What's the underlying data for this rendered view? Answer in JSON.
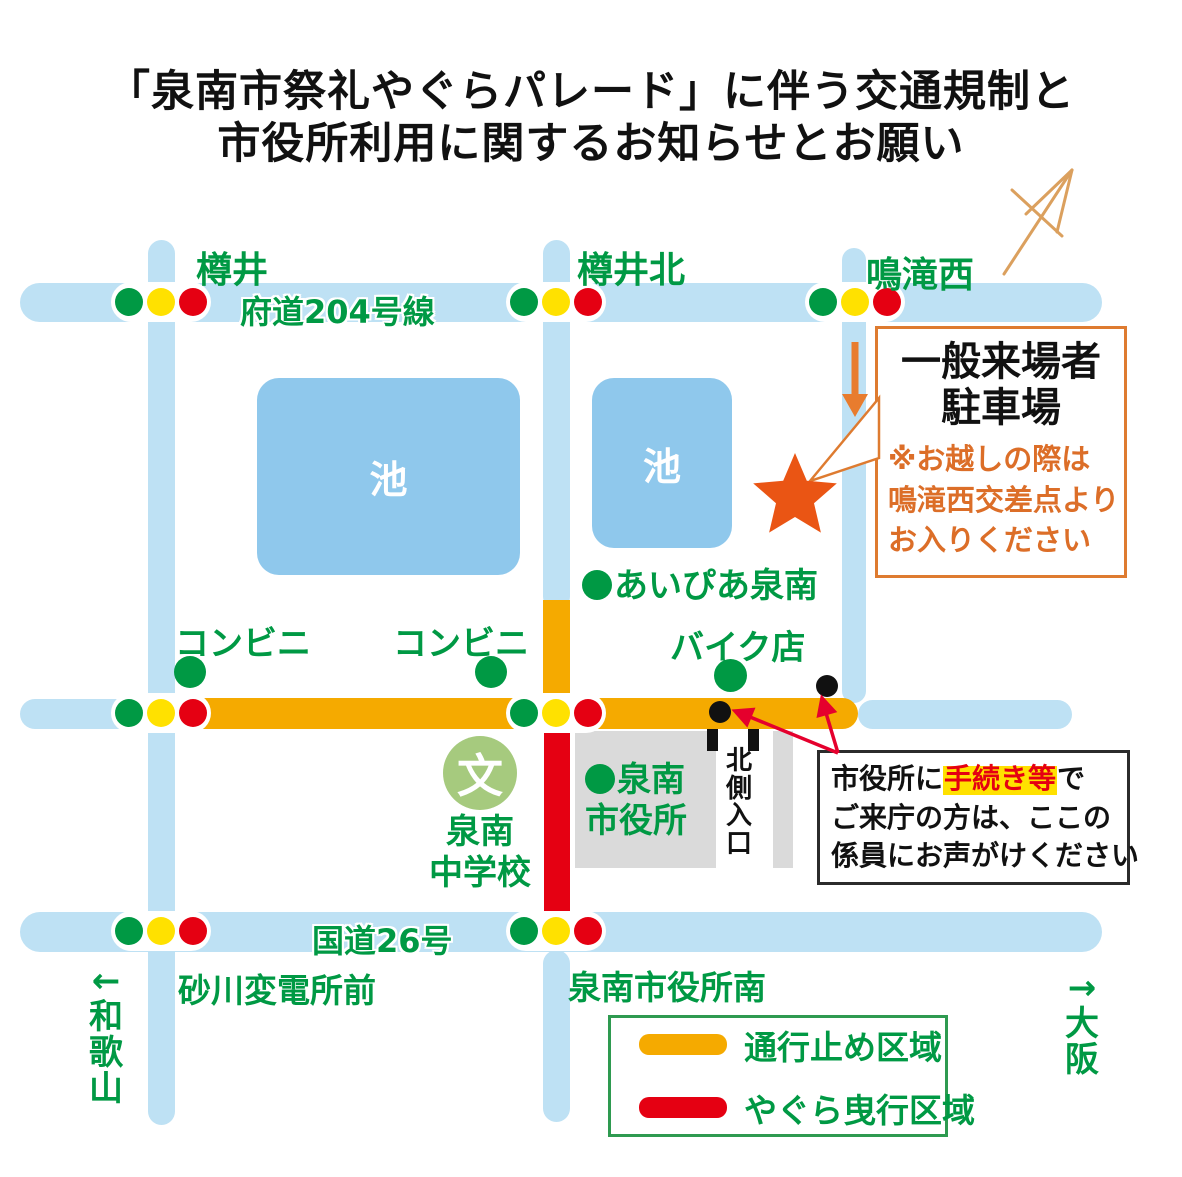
{
  "title": {
    "line1": "「泉南市祭礼やぐらパレード」に伴う交通規制と",
    "line2": "市役所利用に関するお知らせとお願い"
  },
  "map": {
    "road204": "府道204号線",
    "road26": "国道26号",
    "intersections": {
      "tarui": "樽井",
      "tarui_kita": "樽井北",
      "narutaki_nishi": "鳴滝西",
      "sunagawa": "砂川変電所前",
      "shiyakusho_minami": "泉南市役所南"
    },
    "pond": "池",
    "conbini": "コンビニ",
    "bike_shop": "バイク店",
    "aipia": "あいぴあ泉南",
    "cityhall_l1": "泉南",
    "cityhall_l2": "市役所",
    "school_mark": "文",
    "school_l1": "泉南",
    "school_l2": "中学校",
    "north_entrance": "北\n側\n入\n口",
    "dir_wakayama": "←\n和\n歌\n山",
    "dir_osaka": "→\n大\n阪"
  },
  "parking_box": {
    "title": "一般来場者\n駐車場",
    "note": "※お越しの際は\n鳴滝西交差点より\nお入りください"
  },
  "staff_box": {
    "seg1": "市役所に",
    "highlight": "手続き等",
    "seg2": "で",
    "line2": "ご来庁の方は、ここの",
    "line3": "係員にお声がけください"
  },
  "legend": {
    "items": [
      {
        "label": "通行止め区域",
        "color": "#F5AA00"
      },
      {
        "label": "やぐら曳行区域",
        "color": "#E50012"
      }
    ]
  },
  "colors": {
    "road_blue": "#BEE1F4",
    "pond_blue": "#8FC8EC",
    "closed_orange": "#F5AA00",
    "yagura_red": "#E50012",
    "map_green": "#009944",
    "signal_yellow": "#FFE100",
    "block_gray": "#DADADA",
    "star_orange": "#EA5514",
    "note_orange": "#DC6E28",
    "school_green": "#A6CA7E"
  }
}
